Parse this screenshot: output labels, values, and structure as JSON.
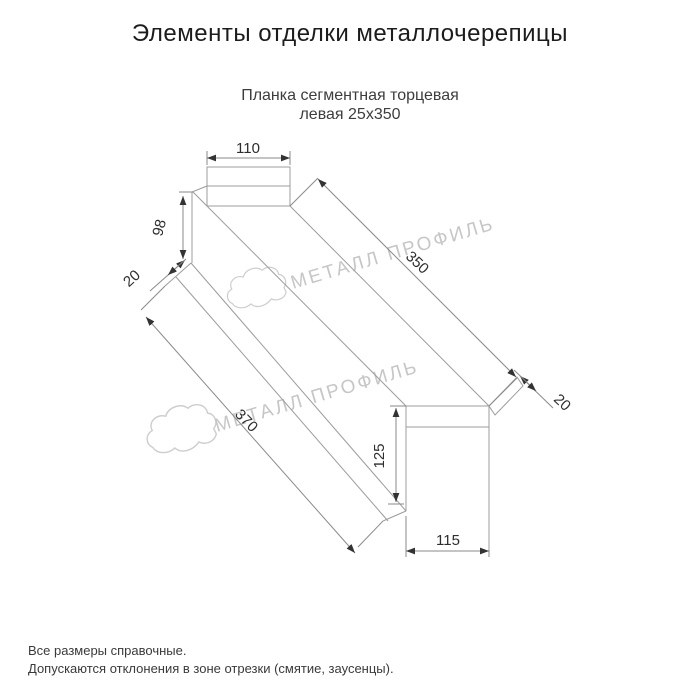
{
  "page": {
    "title": "Элементы отделки металлочерепицы"
  },
  "product": {
    "subtitle_line1": "Планка сегментная торцевая",
    "subtitle_line2": "левая 25x350"
  },
  "dimensions": {
    "top_width": "110",
    "left_height": "98",
    "left_hem": "20",
    "top_length": "350",
    "bottom_length": "370",
    "right_hem": "20",
    "right_height": "125",
    "bottom_width": "115"
  },
  "watermark": {
    "text": "МЕТАЛЛ ПРОФИЛЬ",
    "color": "#c6c6c6"
  },
  "footer": {
    "note1": "Все размеры справочные.",
    "note2": "Допускаются отклонения в зоне отрезки (смятие, заусенцы)."
  },
  "drawing": {
    "line_color": "#9c9c9c",
    "dim_color": "#2e2e2e"
  }
}
